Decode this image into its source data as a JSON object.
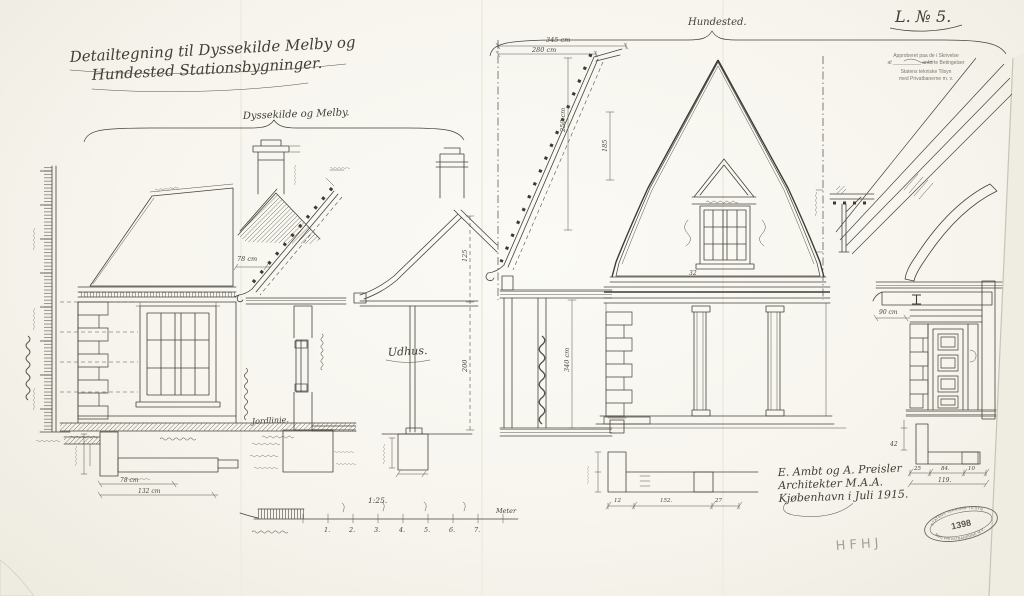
{
  "sheet": {
    "number": "L. № 5."
  },
  "title": {
    "line1": "Detailtegning til Dyssekilde Melby og",
    "line2": "Hundested Stationsbygninger."
  },
  "groups": {
    "left_label": "Dyssekilde og Melby.",
    "right_label": "Hundested."
  },
  "approval_stamp": {
    "line1": "Approberet paa de i Skrivelse",
    "line2": "af  __________  anførte Betingelser",
    "line3": "Statens tekniske Tilsyn",
    "line4": "med Privatbanerne m. v."
  },
  "signature": {
    "line1": "E. Ambt og A. Preisler",
    "line2": "Architekter M.A.A.",
    "line3": "Kjøbenhavn i Juli 1915."
  },
  "oval_stamp": {
    "arc_top": "STATENS TEKNISKE TILSYN",
    "number": "1398",
    "arc_bottom": "MED PRIVATBANERNE M.V."
  },
  "pencil_note": "HFHJ",
  "scale_bar": {
    "ratio": "1:25.",
    "unit": "Meter",
    "ticks": [
      "1.",
      "2.",
      "3.",
      "4.",
      "5.",
      "6.",
      "7."
    ]
  },
  "labels": {
    "udhus": "Udhus.",
    "jordlinie": "Jordlinie."
  },
  "dimensions": {
    "d345": "345 cm",
    "d280": "280 cm",
    "d250": "250 cm",
    "d185": "185",
    "d340": "340 cm",
    "d125": "125",
    "d200": "200",
    "d78_eave": "78 cm",
    "d78_step": "78 cm",
    "d132": "132 cm",
    "d90": "90 cm",
    "d32": "32",
    "d42": "42",
    "d25": "25",
    "d84": "84.",
    "d10": "10",
    "d119": "119.",
    "d12": "12",
    "d152": "152.",
    "d27": "27"
  },
  "colors": {
    "ink": "#45423a",
    "paper": "#f8f6f0",
    "pencil": "#a3a29a",
    "stamp": "#6e6b60"
  }
}
